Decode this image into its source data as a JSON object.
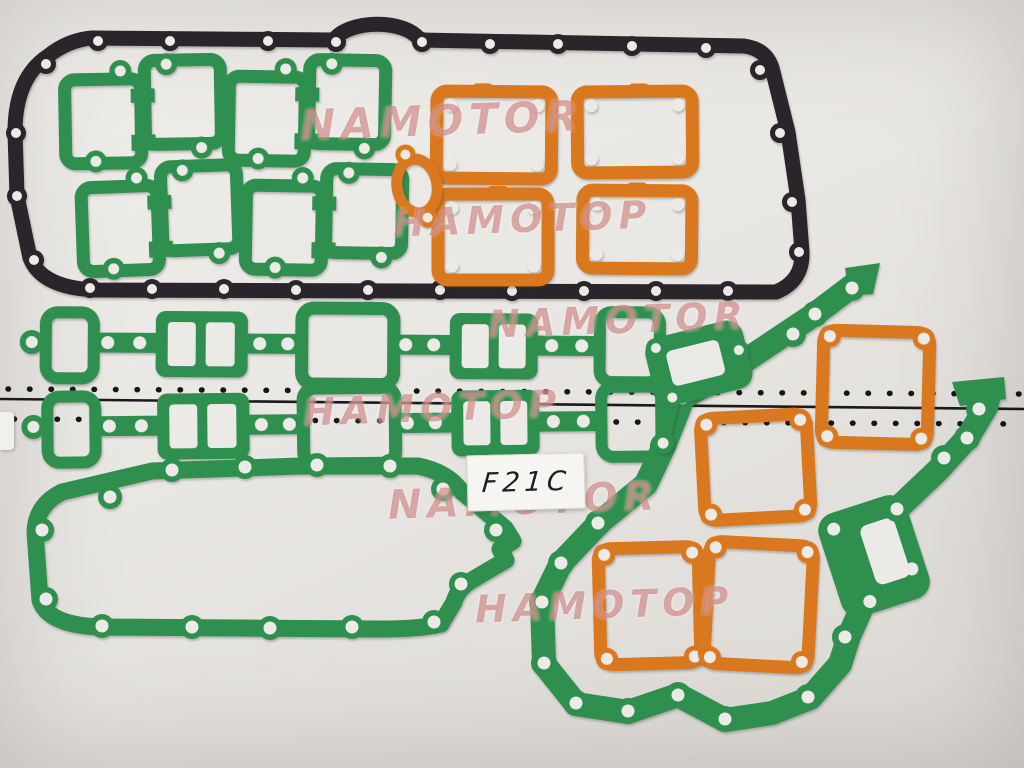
{
  "scene": "full engine gasket set pinned on a white pegboard wall",
  "label": {
    "text": "F21C"
  },
  "watermarks": [
    {
      "text": "NAMOTOR"
    },
    {
      "text": "HAMOTOP"
    },
    {
      "text": "HAMOTOP"
    },
    {
      "text": "NAMOTOR"
    },
    {
      "text": "NAMOTOR"
    },
    {
      "text": "HAMOTOP"
    }
  ],
  "colors": {
    "green": "#2e8f4e",
    "orange": "#d9781e",
    "black": "#29252b",
    "background": "#e9e7e3",
    "hole": "#eceae6",
    "seam_line": "#1a1a1a",
    "dot": "#151515",
    "watermark": "rgba(193,103,98,0.55)",
    "sticker": "#f7f5f1",
    "ink": "#1c2024"
  },
  "parts": [
    {
      "id": "valve-cover-gasket",
      "color": "black"
    },
    {
      "id": "exhaust-port-gasket-1",
      "color": "green"
    },
    {
      "id": "exhaust-port-gasket-2",
      "color": "green"
    },
    {
      "id": "exhaust-port-gasket-3",
      "color": "green"
    },
    {
      "id": "exhaust-port-gasket-4",
      "color": "green"
    },
    {
      "id": "side-cover-gasket-1",
      "color": "orange"
    },
    {
      "id": "side-cover-gasket-2",
      "color": "orange"
    },
    {
      "id": "side-cover-gasket-3",
      "color": "orange"
    },
    {
      "id": "side-cover-gasket-4",
      "color": "orange"
    },
    {
      "id": "water-outlet-gasket",
      "color": "orange"
    },
    {
      "id": "manifold-gasket-1",
      "color": "green"
    },
    {
      "id": "manifold-gasket-2",
      "color": "green"
    },
    {
      "id": "oil-pan-gasket",
      "color": "green"
    },
    {
      "id": "front-cover-gasket",
      "color": "green"
    },
    {
      "id": "water-pump-gasket",
      "color": "green"
    },
    {
      "id": "rocker-cover-gasket-1",
      "color": "orange"
    },
    {
      "id": "rocker-cover-gasket-2",
      "color": "orange"
    },
    {
      "id": "rocker-cover-gasket-3",
      "color": "orange"
    },
    {
      "id": "rocker-cover-gasket-4",
      "color": "orange"
    }
  ]
}
